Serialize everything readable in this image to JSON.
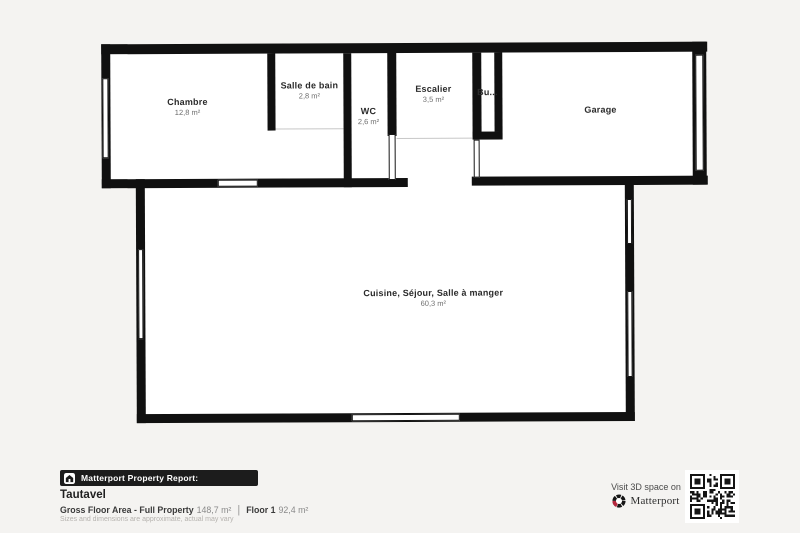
{
  "rooms": [
    {
      "label": "Chambre",
      "area": "12,8 m²"
    },
    {
      "label": "Salle de bain",
      "area": "2,8 m²"
    },
    {
      "label": "WC",
      "area": "2,6 m²"
    },
    {
      "label": "Escalier",
      "area": "3,5 m²"
    },
    {
      "label": "Bu...",
      "area": ""
    },
    {
      "label": "Garage",
      "area": ""
    },
    {
      "label": "Cuisine, Séjour, Salle à manger",
      "area": "60,3 m²"
    }
  ],
  "footer": {
    "badge_label": "Matterport Property Report:",
    "property_name": "Tautavel",
    "gross_area_label": "Gross Floor Area - Full Property",
    "gross_area_value": "148,7 m²",
    "separator": "|",
    "floor_label": "Floor 1",
    "floor_value": "92,4 m²",
    "disclaimer": "Sizes and dimensions are approximate, actual may vary"
  },
  "cta": {
    "visit_label": "Visit 3D space on",
    "brand": "Matterport"
  },
  "colors": {
    "background": "#f4f3f1",
    "wall": "#101010",
    "room_fill": "#ffffff",
    "badge_bg": "#1c1c1c",
    "brand_red": "#b5273d"
  }
}
